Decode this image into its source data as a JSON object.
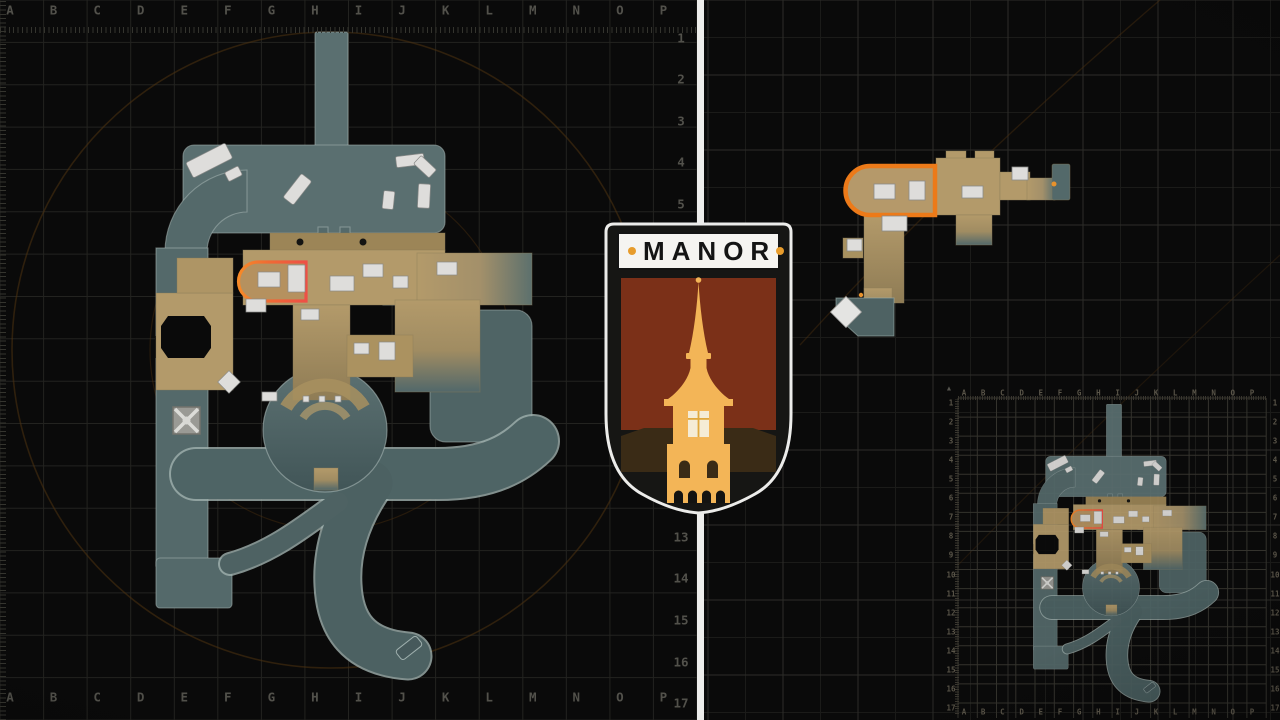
{
  "title": "MANOR",
  "badge": {
    "title": "MANOR"
  },
  "grid": {
    "columns": [
      "A",
      "B",
      "C",
      "D",
      "E",
      "F",
      "G",
      "H",
      "I",
      "J",
      "K",
      "L",
      "M",
      "N",
      "O",
      "P"
    ],
    "rows": [
      "1",
      "2",
      "3",
      "4",
      "5",
      "6",
      "7",
      "8",
      "9",
      "10",
      "11",
      "12",
      "13",
      "14",
      "15",
      "16",
      "17"
    ]
  },
  "icons": {
    "triangle": "▲",
    "crate": "crate-x-icon"
  },
  "colors": {
    "background": "#0a0a0a",
    "grid_line": "#232320",
    "grid_line_right": "#2d2c29",
    "path_teal": "#54696a",
    "building_tan": "#b39a6a",
    "furniture_white": "#dedddb",
    "highlight_orange": "#ec7a19",
    "highlight_red": "#ee4f46",
    "divider": "#ededeb",
    "badge_banner": "#f5f4f1",
    "badge_dot": "#e79c2c",
    "badge_field": "#7b3018",
    "badge_tower": "#f3b557",
    "badge_base": "#3a2b16",
    "compass_arc": "#4f3310",
    "label_gray": "#52514b"
  }
}
